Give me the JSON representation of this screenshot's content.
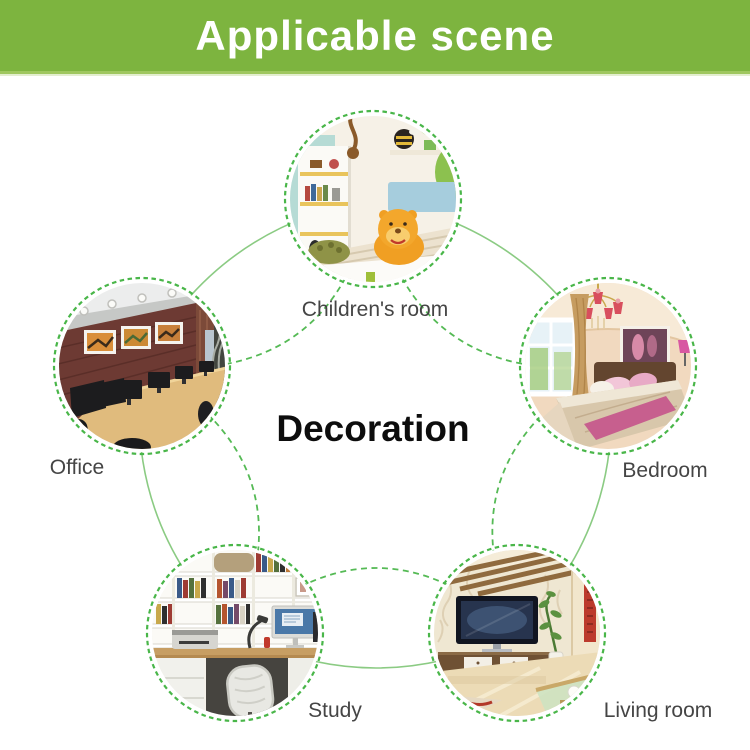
{
  "header": {
    "title": "Applicable scene",
    "bg_color": "#7db43f",
    "text_color": "#ffffff"
  },
  "center": {
    "label": "Decoration"
  },
  "scenes": [
    {
      "id": "children-room",
      "label": "Children's room"
    },
    {
      "id": "bedroom",
      "label": "Bedroom"
    },
    {
      "id": "living-room",
      "label": "Living room"
    },
    {
      "id": "study",
      "label": "Study"
    },
    {
      "id": "office",
      "label": "Office"
    }
  ],
  "diagram": {
    "circle_border_color": "#49b649",
    "dashed_arc_color": "#55ba55",
    "solid_arc_color": "#8bcb83"
  }
}
